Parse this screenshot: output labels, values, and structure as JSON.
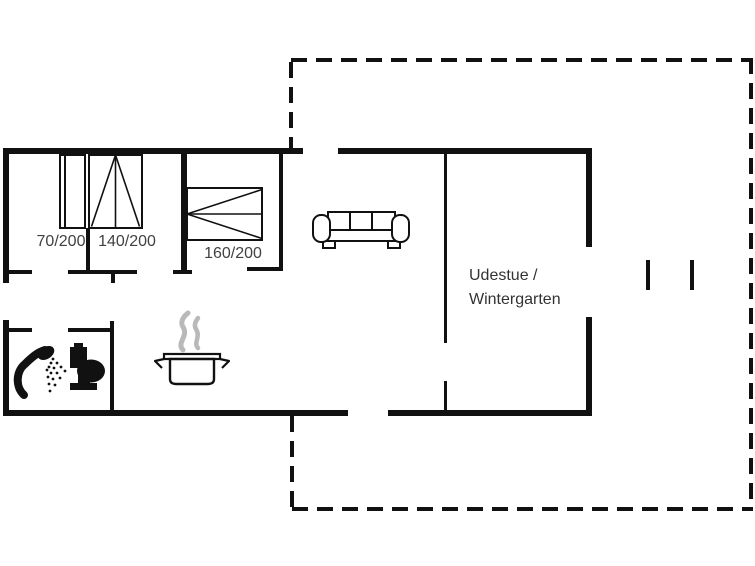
{
  "labels": {
    "bed_small": "70/200",
    "bed_double": "140/200",
    "bed_master": "160/200",
    "conservatory_line1": "Udestue /",
    "conservatory_line2": "Wintergarten"
  },
  "colors": {
    "wall": "#111111",
    "label": "#414141",
    "roomlabel": "#333333",
    "steam": "#b9b9b9",
    "bg": "#ffffff"
  },
  "icons": {
    "shower": "shower-icon",
    "toilet": "toilet-icon",
    "cooking_pot": "cooking-pot-icon",
    "steam": "steam-icon",
    "sofa": "sofa-icon",
    "bed_small": "bed-70-icon",
    "bed_double": "bed-140-icon",
    "bed_master": "bed-160-icon",
    "wall_opening": "wall-opening-ticks"
  }
}
